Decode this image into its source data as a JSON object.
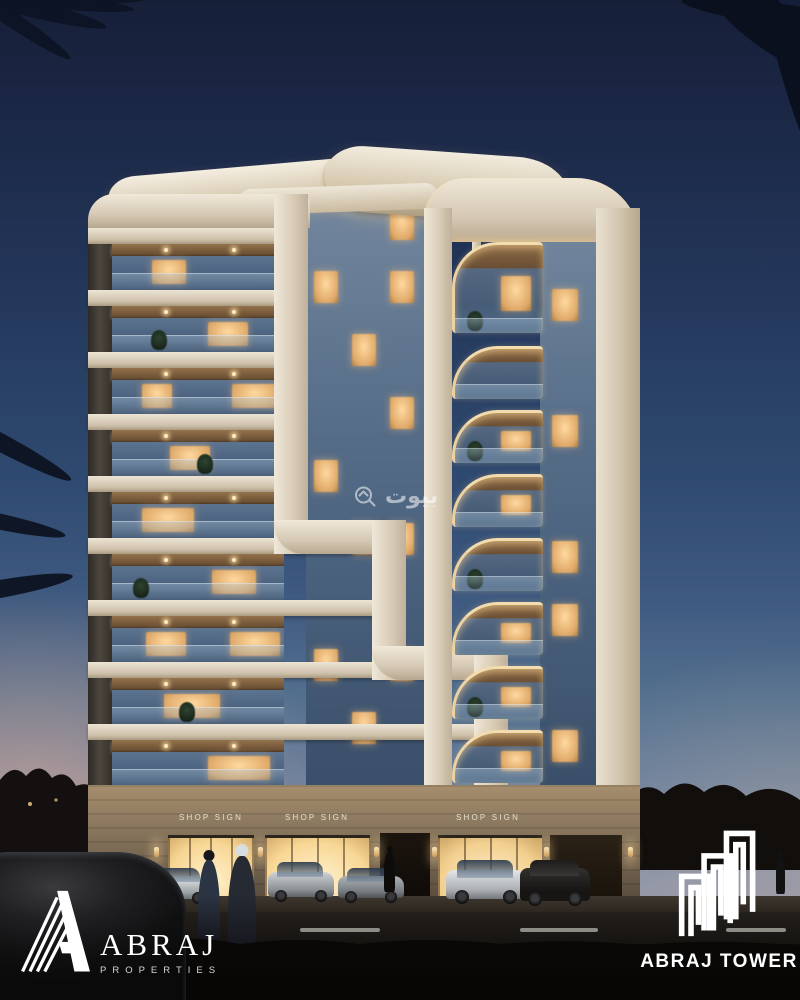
{
  "scene": {
    "shop_signs": [
      {
        "label": "SHOP SIGN"
      },
      {
        "label": "SHOP SIGN"
      },
      {
        "label": "SHOP SIGN"
      }
    ],
    "watermark": {
      "text": "بيوت",
      "icon": "bayut-house-search-icon"
    },
    "logo_properties": {
      "title": "ABRAJ",
      "subtitle": "PROPERTIES",
      "icon": "abraj-striped-a-mark"
    },
    "logo_tower": {
      "title": "ABRAJ TOWER",
      "icon": "abraj-tower-building-mark"
    }
  },
  "colors": {
    "sky_top": "#161f38",
    "sky_mid": "#3f5a80",
    "sunset_glow": "#eeb094",
    "facade_cream": "#e6dccb",
    "wood_soffit": "#7a5c3a",
    "glass_blue": "#4b6280",
    "window_warm": "#ffd9a0",
    "stone_ground": "#8d7c64",
    "shop_light": "#ffe9bd",
    "asphalt": "#1d1a17",
    "logo_white": "#ffffff"
  },
  "building": {
    "left_floors": 9,
    "right_balconies": 8,
    "left_lit": [
      [
        0,
        40,
        34
      ],
      [
        1,
        96,
        40
      ],
      [
        2,
        30,
        30
      ],
      [
        2,
        120,
        46
      ],
      [
        3,
        58,
        40
      ],
      [
        4,
        30,
        52
      ],
      [
        5,
        100,
        44
      ],
      [
        6,
        34,
        40
      ],
      [
        6,
        118,
        50
      ],
      [
        7,
        52,
        56
      ],
      [
        8,
        96,
        62
      ]
    ],
    "mid_lit_cells": [
      [
        0,
        2
      ],
      [
        1,
        0
      ],
      [
        1,
        2
      ],
      [
        2,
        1
      ],
      [
        3,
        2
      ],
      [
        4,
        0
      ],
      [
        5,
        1
      ],
      [
        5,
        2
      ],
      [
        7,
        0
      ],
      [
        7,
        2
      ],
      [
        8,
        1
      ]
    ],
    "right_strip_lit": [
      1,
      3,
      5,
      6,
      8
    ],
    "right_cell_lit": [
      0,
      2,
      3,
      5,
      6,
      7
    ]
  }
}
